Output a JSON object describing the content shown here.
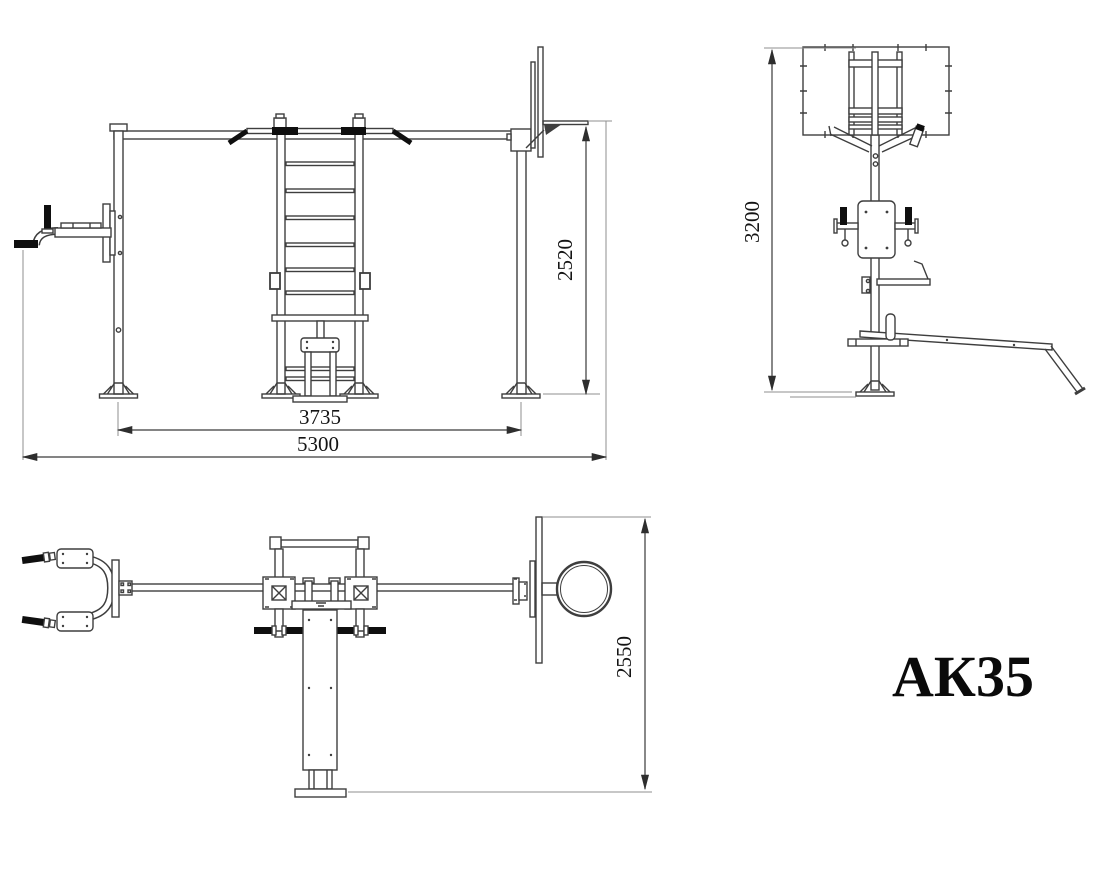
{
  "drawing": {
    "code": "АК35",
    "front_view": {
      "dim_frame_width": "3735",
      "dim_overall_width": "5300",
      "dim_rim_height": "2520"
    },
    "side_view": {
      "dim_overall_height": "3200"
    },
    "plan_view": {
      "dim_overall_depth": "2550"
    }
  },
  "colors": {
    "background": "#ffffff",
    "line": "#3e3e3e",
    "grip": "#0f0f0f",
    "dim_text": "#141414"
  }
}
